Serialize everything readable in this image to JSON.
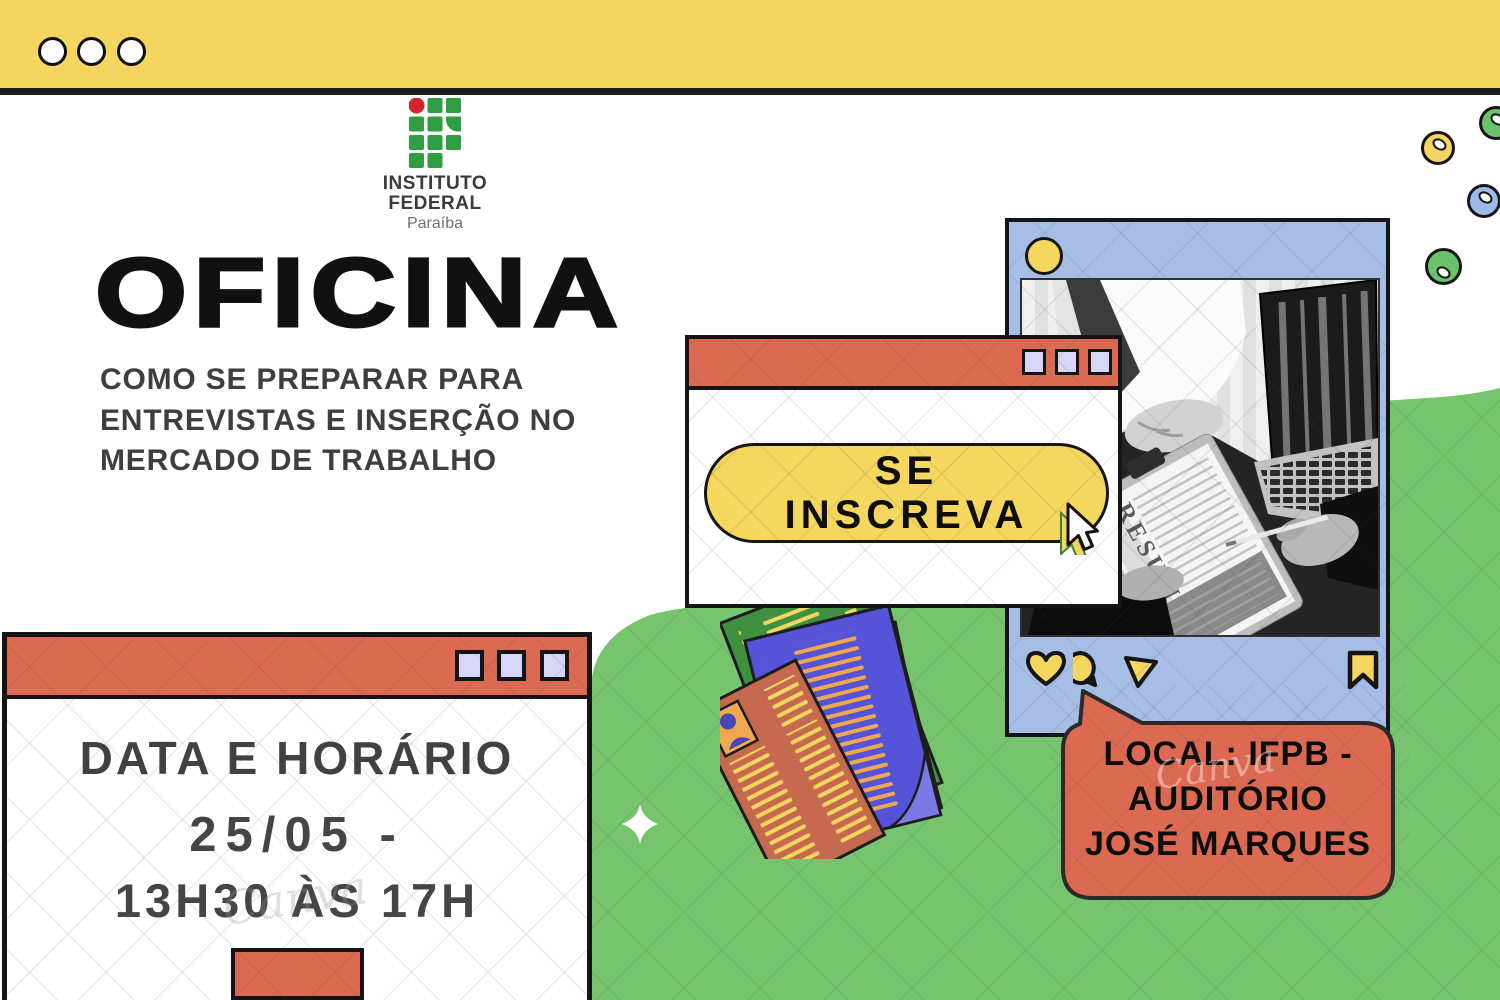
{
  "top_bar": {
    "dot_count": 3
  },
  "logo": {
    "line1": "INSTITUTO",
    "line2": "FEDERAL",
    "line3": "Paraíba"
  },
  "hero": {
    "title": "OFICINA",
    "subtitle_line1": "COMO SE PREPARAR PARA",
    "subtitle_line2": "ENTREVISTAS E INSERÇÃO NO",
    "subtitle_line3": "MERCADO DE TRABALHO"
  },
  "signup_window": {
    "button_line1": "SE",
    "button_line2": "INSCREVA"
  },
  "schedule_window": {
    "heading": "DATA E HORÁRIO",
    "date_line": "25/05 -",
    "time_line": "13H30 ÀS 17H"
  },
  "location_bubble": {
    "line1": "LOCAL: IFPB -",
    "line2": "AUDITÓRIO",
    "line3": "JOSÉ MARQUES"
  },
  "photo_card": {
    "resume_label": "RESUME"
  },
  "watermark": {
    "text": "Canva"
  },
  "icons": {
    "like": "heart-icon",
    "comment": "comment-icon",
    "share": "share-icon",
    "save": "bookmark-icon",
    "pointer": "cursor-icon",
    "highlight": "sparkle-icon"
  },
  "colors": {
    "bar_yellow": "#F3D55F",
    "salmon": "#DC6A52",
    "lavender": "#D7D6F6",
    "card_blue": "#A6BEE5",
    "background_green": "#77C46F",
    "pill_yellow": "#F5D65E",
    "logo_green": "#2F9E41",
    "logo_red": "#D1252B",
    "ink": "#141414",
    "heading_gray": "#3E3E3E"
  }
}
